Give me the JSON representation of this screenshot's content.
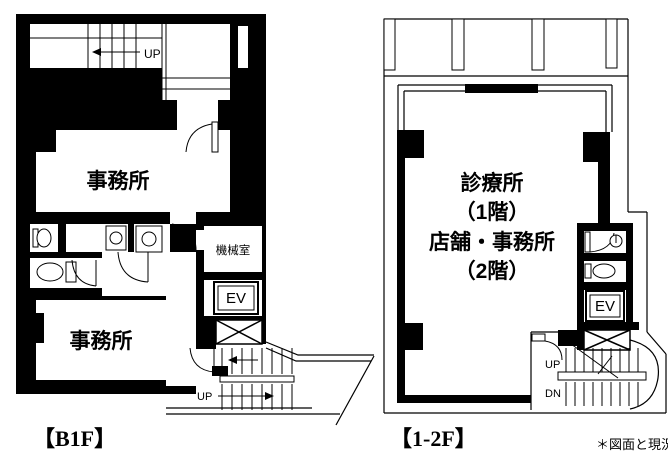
{
  "colors": {
    "ink": "#000000",
    "paper": "#ffffff"
  },
  "plans": {
    "b1f": {
      "floor_label": "【B1F】",
      "rooms": {
        "office_upper": "事務所",
        "office_lower": "事務所",
        "machine_room": "機械室",
        "elevator": "EV"
      },
      "stairs": {
        "top_up": "UP",
        "bottom_up": "UP"
      }
    },
    "f12": {
      "floor_label": "【1-2F】",
      "room_lines": [
        "診療所",
        "（1階）",
        "店舗・事務所",
        "（2階）"
      ],
      "elevator": "EV",
      "stairs": {
        "up": "UP",
        "down": "DN"
      }
    }
  },
  "note": "＊図面と現況"
}
